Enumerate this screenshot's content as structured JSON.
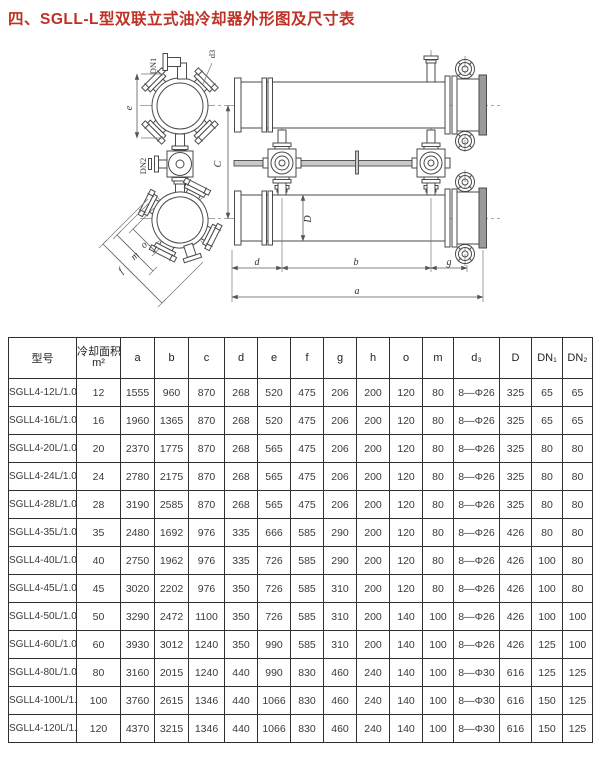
{
  "page": {
    "title": "四、SGLL-L型双联立式油冷却器外形图及尺寸表",
    "title_color": "#bf3124"
  },
  "drawing": {
    "labels": {
      "dn1": "DN1",
      "d3_leader": "d3",
      "e": "e",
      "dn2": "DN2",
      "c": "C",
      "d_big": "D",
      "o": "o",
      "m": "m",
      "f": "f",
      "d": "d",
      "b": "b",
      "g": "g",
      "a": "a"
    }
  },
  "table": {
    "col_model": "型号",
    "col_area_line1": "冷却面积",
    "col_area_line2": "m²",
    "cols": [
      "a",
      "b",
      "c",
      "d",
      "e",
      "f",
      "g",
      "h",
      "o",
      "m",
      "d₃",
      "D",
      "DN₁",
      "DN₂"
    ],
    "rows": [
      [
        "SGLL4-12L/1.0",
        "12",
        "1555",
        "960",
        "870",
        "268",
        "520",
        "475",
        "206",
        "200",
        "120",
        "80",
        "8—Φ26",
        "325",
        "65",
        "65"
      ],
      [
        "SGLL4-16L/1.0",
        "16",
        "1960",
        "1365",
        "870",
        "268",
        "520",
        "475",
        "206",
        "200",
        "120",
        "80",
        "8—Φ26",
        "325",
        "65",
        "65"
      ],
      [
        "SGLL4-20L/1.0",
        "20",
        "2370",
        "1775",
        "870",
        "268",
        "565",
        "475",
        "206",
        "200",
        "120",
        "80",
        "8—Φ26",
        "325",
        "80",
        "80"
      ],
      [
        "SGLL4-24L/1.0",
        "24",
        "2780",
        "2175",
        "870",
        "268",
        "565",
        "475",
        "206",
        "200",
        "120",
        "80",
        "8—Φ26",
        "325",
        "80",
        "80"
      ],
      [
        "SGLL4-28L/1.0",
        "28",
        "3190",
        "2585",
        "870",
        "268",
        "565",
        "475",
        "206",
        "200",
        "120",
        "80",
        "8—Φ26",
        "325",
        "80",
        "80"
      ],
      [
        "SGLL4-35L/1.0",
        "35",
        "2480",
        "1692",
        "976",
        "335",
        "666",
        "585",
        "290",
        "200",
        "120",
        "80",
        "8—Φ26",
        "426",
        "80",
        "80"
      ],
      [
        "SGLL4-40L/1.0",
        "40",
        "2750",
        "1962",
        "976",
        "335",
        "726",
        "585",
        "290",
        "200",
        "120",
        "80",
        "8—Φ26",
        "426",
        "100",
        "80"
      ],
      [
        "SGLL4-45L/1.0",
        "45",
        "3020",
        "2202",
        "976",
        "350",
        "726",
        "585",
        "310",
        "200",
        "120",
        "80",
        "8—Φ26",
        "426",
        "100",
        "80"
      ],
      [
        "SGLL4-50L/1.0",
        "50",
        "3290",
        "2472",
        "1100",
        "350",
        "726",
        "585",
        "310",
        "200",
        "140",
        "100",
        "8—Φ26",
        "426",
        "100",
        "100"
      ],
      [
        "SGLL4-60L/1.0",
        "60",
        "3930",
        "3012",
        "1240",
        "350",
        "990",
        "585",
        "310",
        "200",
        "140",
        "100",
        "8—Φ26",
        "426",
        "125",
        "100"
      ],
      [
        "SGLL4-80L/1.0",
        "80",
        "3160",
        "2015",
        "1240",
        "440",
        "990",
        "830",
        "460",
        "240",
        "140",
        "100",
        "8—Φ30",
        "616",
        "125",
        "125"
      ],
      [
        "SGLL4-100L/1.0",
        "100",
        "3760",
        "2615",
        "1346",
        "440",
        "1066",
        "830",
        "460",
        "240",
        "140",
        "100",
        "8—Φ30",
        "616",
        "150",
        "125"
      ],
      [
        "SGLL4-120L/1.0",
        "120",
        "4370",
        "3215",
        "1346",
        "440",
        "1066",
        "830",
        "460",
        "240",
        "140",
        "100",
        "8—Φ30",
        "616",
        "150",
        "125"
      ]
    ]
  }
}
